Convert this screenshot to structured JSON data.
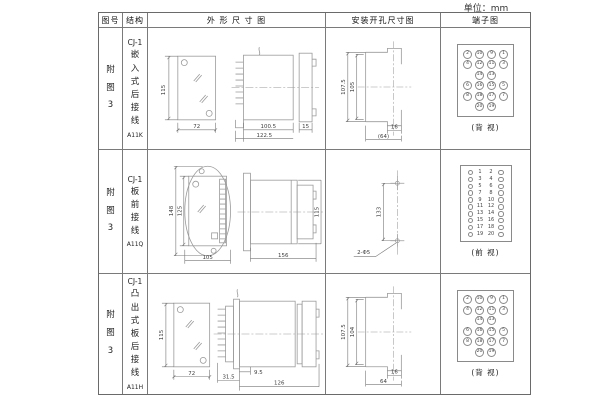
{
  "unit_label": "单位：mm",
  "table": {
    "headers": {
      "fig": "图号",
      "structure": "结构",
      "outline": "外 形 尺 寸 图",
      "install": "安装开孔尺寸图",
      "terminal": "端子图"
    },
    "rows": [
      {
        "fig": "附图3",
        "series": "CJ-1",
        "structure": "嵌入式后接线",
        "model": "A11K",
        "outline_dims": {
          "front_h": "115",
          "front_w": "72",
          "depth_inner": "100.5",
          "depth_total": "122.5",
          "flange": "15"
        },
        "install_dims": {
          "outer_h": "107.5",
          "inner_h": "105",
          "slot_w": "16",
          "overall_w": "(64)"
        },
        "terminal": {
          "type": "grid",
          "rows": [
            [
              "2",
              "10",
              "9",
              "1"
            ],
            [
              "4",
              "12",
              "11",
              "3"
            ],
            [
              null,
              "14",
              "13",
              null
            ],
            [
              "6",
              "16",
              "15",
              "5"
            ],
            [
              "8",
              "18",
              "17",
              "7"
            ],
            [
              null,
              "20",
              "19",
              null
            ]
          ],
          "caption": "(背 视)"
        }
      },
      {
        "fig": "附图3",
        "series": "CJ-1",
        "structure": "板前接线",
        "model": "A11Q",
        "outline_dims": {
          "front_h_outer": "148",
          "front_h_inner": "125",
          "front_w": "105",
          "depth": "156",
          "side_h": "115"
        },
        "install_dims": {
          "hole_spacing": "133",
          "holes": "2-Φ5"
        },
        "terminal": {
          "type": "pairs",
          "rows": [
            [
              "1",
              "2"
            ],
            [
              "3",
              "4"
            ],
            [
              "5",
              "6"
            ],
            [
              "7",
              "8"
            ],
            [
              "9",
              "10"
            ],
            [
              "11",
              "12"
            ],
            [
              "13",
              "14"
            ],
            [
              "15",
              "16"
            ],
            [
              "17",
              "18"
            ],
            [
              "19",
              "20"
            ]
          ],
          "caption": "(前 视)"
        }
      },
      {
        "fig": "附图3",
        "series": "CJ-1",
        "structure": "凸出式板后接线",
        "model": "A11H",
        "outline_dims": {
          "front_h": "115",
          "front_w": "72",
          "pin_len": "31.5",
          "gap": "9.5",
          "depth": "126"
        },
        "install_dims": {
          "outer_h": "107.5",
          "inner_h": "104",
          "slot_w": "16",
          "overall_w": "64"
        },
        "terminal": {
          "type": "grid",
          "rows": [
            [
              "2",
              "10",
              "9",
              "1"
            ],
            [
              "4",
              "12",
              "11",
              "3"
            ],
            [
              null,
              "14",
              "13",
              null
            ],
            [
              "6",
              "16",
              "15",
              "5"
            ],
            [
              "8",
              "18",
              "17",
              "7"
            ],
            [
              null,
              "20",
              "19",
              null
            ]
          ],
          "caption": "(背 视)"
        }
      }
    ]
  }
}
